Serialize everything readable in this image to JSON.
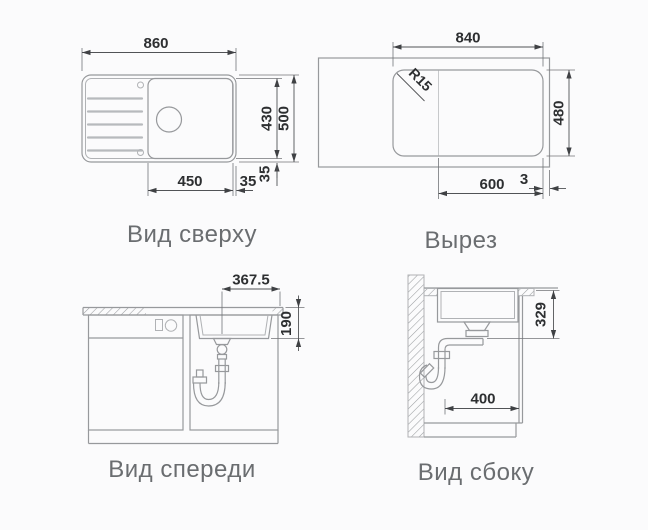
{
  "canvas": {
    "background": "#fbfbfc"
  },
  "views": {
    "top_view": {
      "caption": "Вид сверху",
      "dims": {
        "overall_width": "860",
        "bowl_height": "430",
        "overall_depth": "500",
        "bowl_width": "450",
        "edge_offset_horizontal": "35",
        "edge_offset_vertical": "35"
      }
    },
    "cutout_view": {
      "caption": "Вырез",
      "dims": {
        "cutout_width": "840",
        "corner_radius": "R15",
        "cutout_height": "480",
        "bowl_zone_width": "600",
        "edge_gap": "3"
      }
    },
    "front_view": {
      "caption": "Вид спереди",
      "dims": {
        "drain_to_edge": "367.5",
        "bowl_depth": "190"
      }
    },
    "side_view": {
      "caption": "Вид сбоку",
      "dims": {
        "clearance_depth": "400",
        "drain_height": "329"
      }
    }
  }
}
